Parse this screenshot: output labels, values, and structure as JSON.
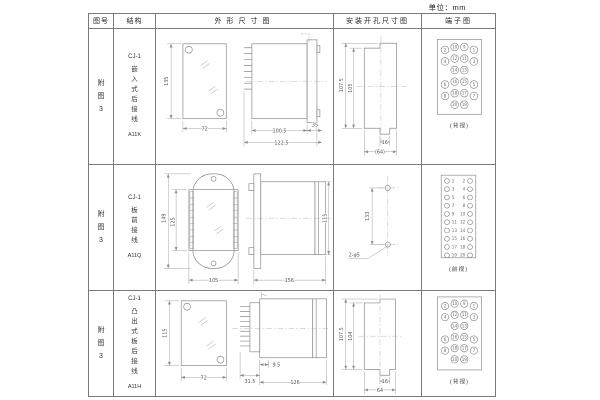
{
  "unit_label": "单位：mm",
  "headers": {
    "fig_no": "图号",
    "structure": "结构",
    "outline": "外形尺寸图",
    "mounting": "安装开孔尺寸图",
    "terminal": "端子图"
  },
  "rows": [
    {
      "fig_no": "附图3",
      "series": "CJ-1",
      "structure_type": "嵌入式后接线",
      "model": "A11K",
      "outline": {
        "height": "135",
        "width": "72",
        "len1": "100.5",
        "len2": "122.5",
        "flange": "35"
      },
      "mounting": {
        "outer": "107.5",
        "inner": "105",
        "slot": "16",
        "width": "(64)"
      },
      "terminal": {
        "label": "(背视)",
        "type": "rear",
        "grid": [
          [
            2,
            10,
            9,
            1
          ],
          [
            4,
            12,
            11,
            3
          ],
          [
            null,
            14,
            13,
            null
          ],
          [
            6,
            16,
            15,
            5
          ],
          [
            8,
            18,
            17,
            7
          ],
          [
            null,
            20,
            19,
            null
          ]
        ]
      }
    },
    {
      "fig_no": "附图3",
      "series": "CJ-1",
      "structure_type": "板前接线",
      "model": "A11Q",
      "outline": {
        "height": "149",
        "inner_height": "125",
        "width": "105",
        "length": "156",
        "side_height": "115"
      },
      "mounting": {
        "spacing": "133",
        "holes": "2-φ5"
      },
      "terminal": {
        "label": "(前视)",
        "type": "front",
        "left": [
          1,
          3,
          5,
          7,
          9,
          11,
          13,
          15,
          17,
          19
        ],
        "right": [
          2,
          4,
          6,
          8,
          10,
          12,
          14,
          16,
          18,
          20
        ]
      }
    },
    {
      "fig_no": "附图3",
      "series": "CJ-1",
      "structure_type": "凸出式板后接线",
      "model": "A11H",
      "outline": {
        "height": "115",
        "width": "72",
        "base": "31.5",
        "offset": "9.5",
        "length": "126"
      },
      "mounting": {
        "outer": "107.5",
        "inner": "104",
        "slot": "16",
        "width": "64"
      },
      "terminal": {
        "label": "(背视)",
        "type": "rear",
        "grid": [
          [
            2,
            10,
            9,
            1
          ],
          [
            4,
            12,
            11,
            3
          ],
          [
            null,
            14,
            13,
            null
          ],
          [
            6,
            16,
            15,
            5
          ],
          [
            8,
            18,
            17,
            7
          ],
          [
            null,
            20,
            19,
            null
          ]
        ]
      }
    }
  ]
}
